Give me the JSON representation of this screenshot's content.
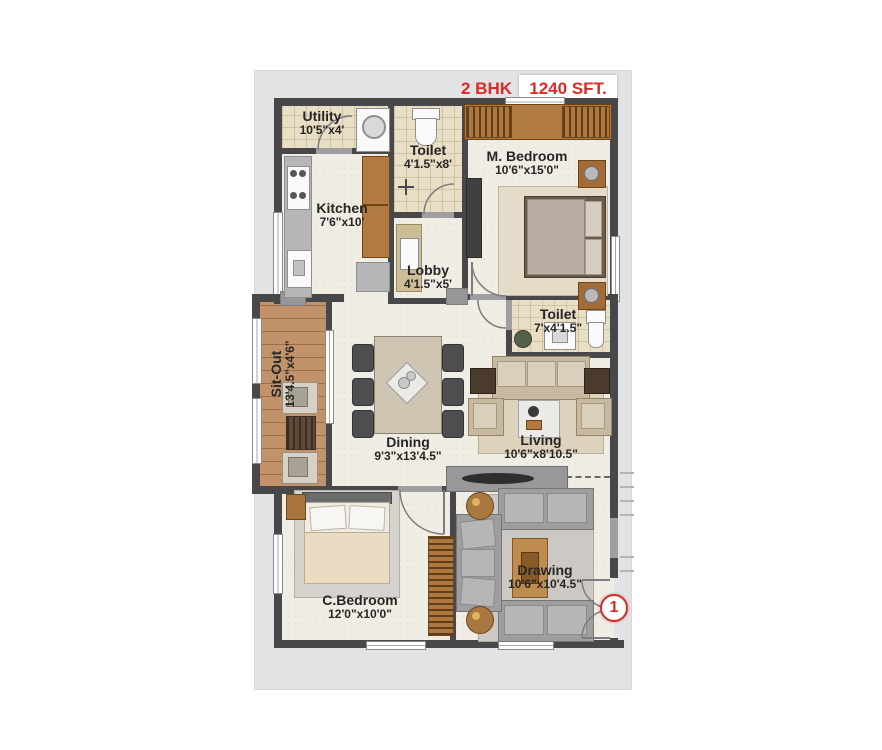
{
  "header": {
    "bhk": "2 BHK",
    "area": "1240 SFT."
  },
  "rooms": {
    "utility": {
      "name": "Utility",
      "dims": "10'5\"x4'"
    },
    "toilet1": {
      "name": "Toilet",
      "dims": "4'1.5\"x8'"
    },
    "m_bedroom": {
      "name": "M. Bedroom",
      "dims": "10'6\"x15'0\""
    },
    "kitchen": {
      "name": "Kitchen",
      "dims": "7'6\"x10'"
    },
    "lobby": {
      "name": "Lobby",
      "dims": "4'1.5\"x5'"
    },
    "sit_out": {
      "name": "Sit-Out",
      "dims": "13'4.5\"x4'6\""
    },
    "toilet2": {
      "name": "Toilet",
      "dims": "7'x4'1.5\""
    },
    "dining": {
      "name": "Dining",
      "dims": "9'3\"x13'4.5\""
    },
    "living": {
      "name": "Living",
      "dims": "10'6\"x8'10.5\""
    },
    "c_bedroom": {
      "name": "C.Bedroom",
      "dims": "12'0\"x10'0\""
    },
    "drawing": {
      "name": "Drawing",
      "dims": "10'6\"x10'4.5\""
    }
  },
  "entrance": {
    "marker": "1"
  },
  "colors": {
    "accent_red": "#dc2a2a",
    "wall": "#48484b",
    "panel": "#e3e3e5"
  }
}
